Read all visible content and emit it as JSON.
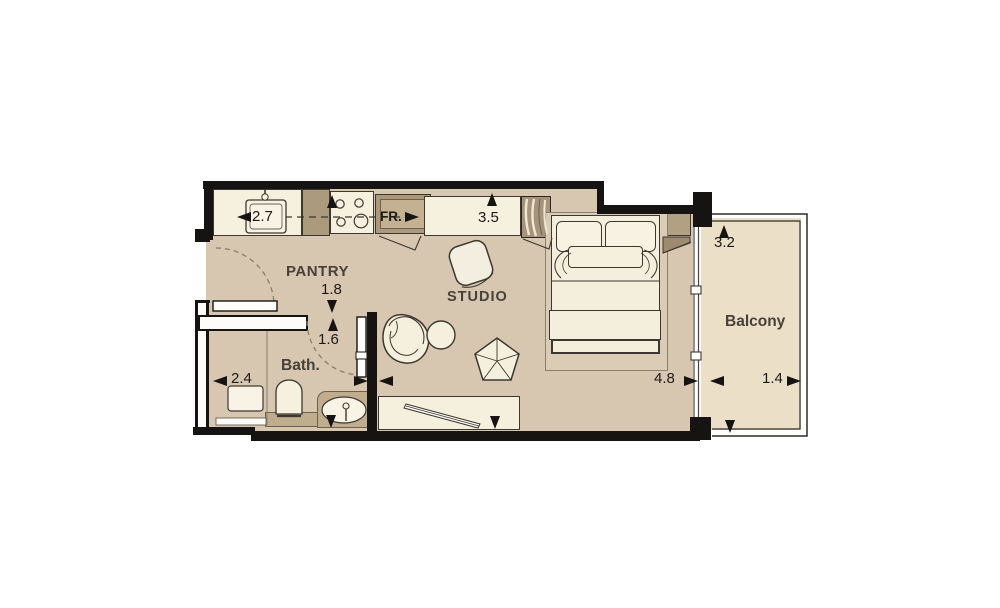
{
  "plan": {
    "rooms": {
      "pantry": "PANTRY",
      "studio": "STUDIO",
      "bath": "Bath.",
      "balcony": "Balcony"
    },
    "appliances": {
      "fridge": "FR."
    },
    "dimensions": {
      "kitchen_run": "2.7",
      "studio_depth": "3.5",
      "pantry_depth": "1.8",
      "bath_depth": "1.6",
      "bath_width": "2.4",
      "studio_width": "4.8",
      "balcony_depth": "3.2",
      "balcony_width": "1.4"
    },
    "colors": {
      "wall": "#161412",
      "floor": "#d7c6b0",
      "balcony_floor": "#ecdfc8",
      "furniture_cream": "#f5efde",
      "cabinet_tan": "#ac9a7c",
      "wood_tan": "#b2a083",
      "counter_tan": "#bfad8d",
      "rug": "#dbccb5"
    }
  }
}
